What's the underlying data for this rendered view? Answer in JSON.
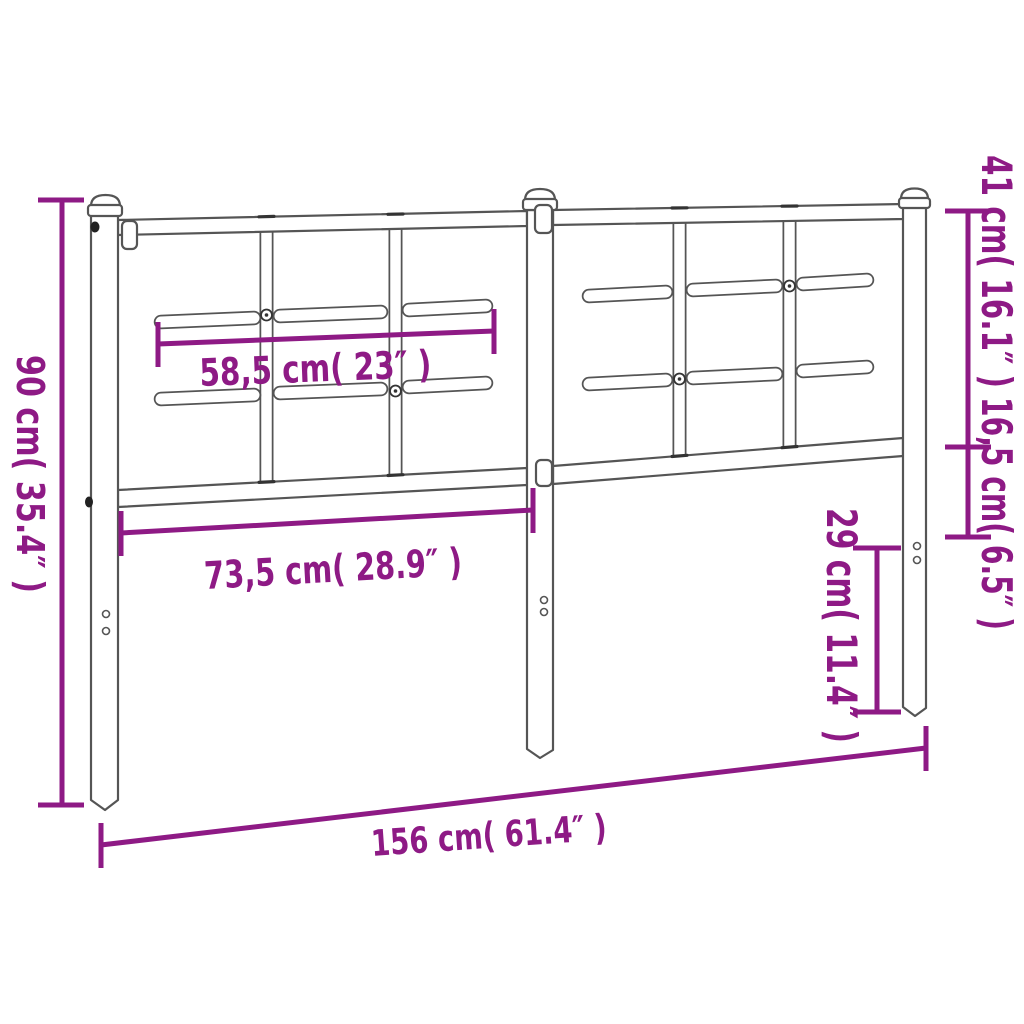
{
  "title": "Metal headboard dimension diagram",
  "colors": {
    "dimension_accent": "#8E1A85",
    "frame_line": "#555555",
    "background": "#FFFFFF"
  },
  "labels": {
    "overall_height": "90 cm( 35.4″ )",
    "crossbar_width": "58,5 cm( 23″ )",
    "lower_rail_width": "73,5 cm( 28.9″ )",
    "overall_width": "156 cm( 61.4″ )",
    "panel_height": "41 cm( 16.1″ )",
    "rail_to_mount_height": "16,5 cm( 6.5″ )",
    "leg_height": "29 cm( 11.4″ )"
  }
}
